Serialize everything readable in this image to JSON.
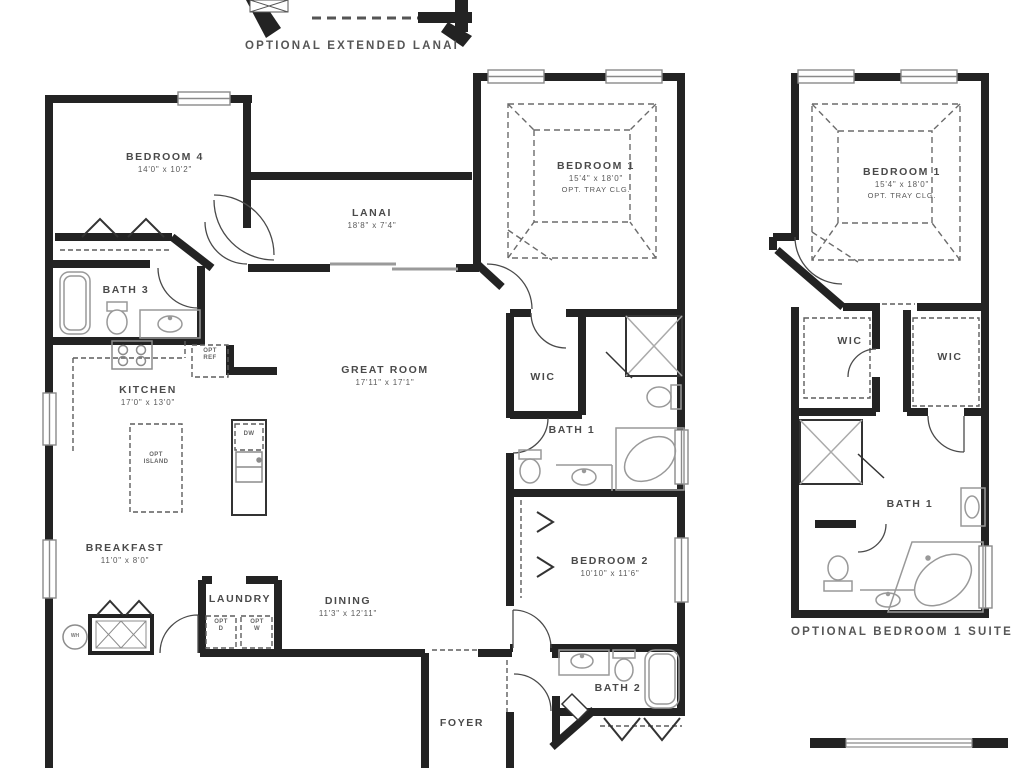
{
  "captions": {
    "optional_extended_lanai": "OPTIONAL EXTENDED LANAI",
    "optional_bedroom1_suite": "OPTIONAL BEDROOM 1 SUITE"
  },
  "rooms": {
    "bedroom4": {
      "name": "BEDROOM 4",
      "dims": "14'0\" x 10'2\""
    },
    "bath3": {
      "name": "BATH 3"
    },
    "lanai": {
      "name": "LANAI",
      "dims": "18'8\" x 7'4\""
    },
    "bedroom1": {
      "name": "BEDROOM 1",
      "dims": "15'4\" x 18'0\"",
      "note": "OPT. TRAY CLG."
    },
    "great_room": {
      "name": "GREAT ROOM",
      "dims": "17'11\" x 17'1\""
    },
    "kitchen": {
      "name": "KITCHEN",
      "dims": "17'0\" x 13'0\""
    },
    "breakfast": {
      "name": "BREAKFAST",
      "dims": "11'0\" x 8'0\""
    },
    "laundry": {
      "name": "LAUNDRY"
    },
    "dining": {
      "name": "DINING",
      "dims": "11'3\" x 12'11\""
    },
    "foyer": {
      "name": "FOYER"
    },
    "wic": {
      "name": "WIC"
    },
    "bath1": {
      "name": "BATH 1"
    },
    "bedroom2": {
      "name": "BEDROOM 2",
      "dims": "10'10\" x 11'6\""
    },
    "bath2": {
      "name": "BATH 2"
    }
  },
  "suite": {
    "bedroom1": {
      "name": "BEDROOM 1",
      "dims": "15'4\" x 18'0\"",
      "note": "OPT. TRAY CLG."
    },
    "wic_left": "WIC",
    "wic_right": "WIC",
    "bath1": "BATH 1"
  },
  "annotations": {
    "opt_ref": "OPT\nREF",
    "opt_island": "OPT\nISLAND",
    "dw": "DW",
    "opt_d": "OPT\nD",
    "opt_w": "OPT\nW",
    "wh": "WH"
  },
  "colors": {
    "wall": "#232323",
    "fixture_line": "#9a9a9a",
    "label_text": "#4d4d4d",
    "dashed_optional": "#666666",
    "background": "#ffffff"
  }
}
